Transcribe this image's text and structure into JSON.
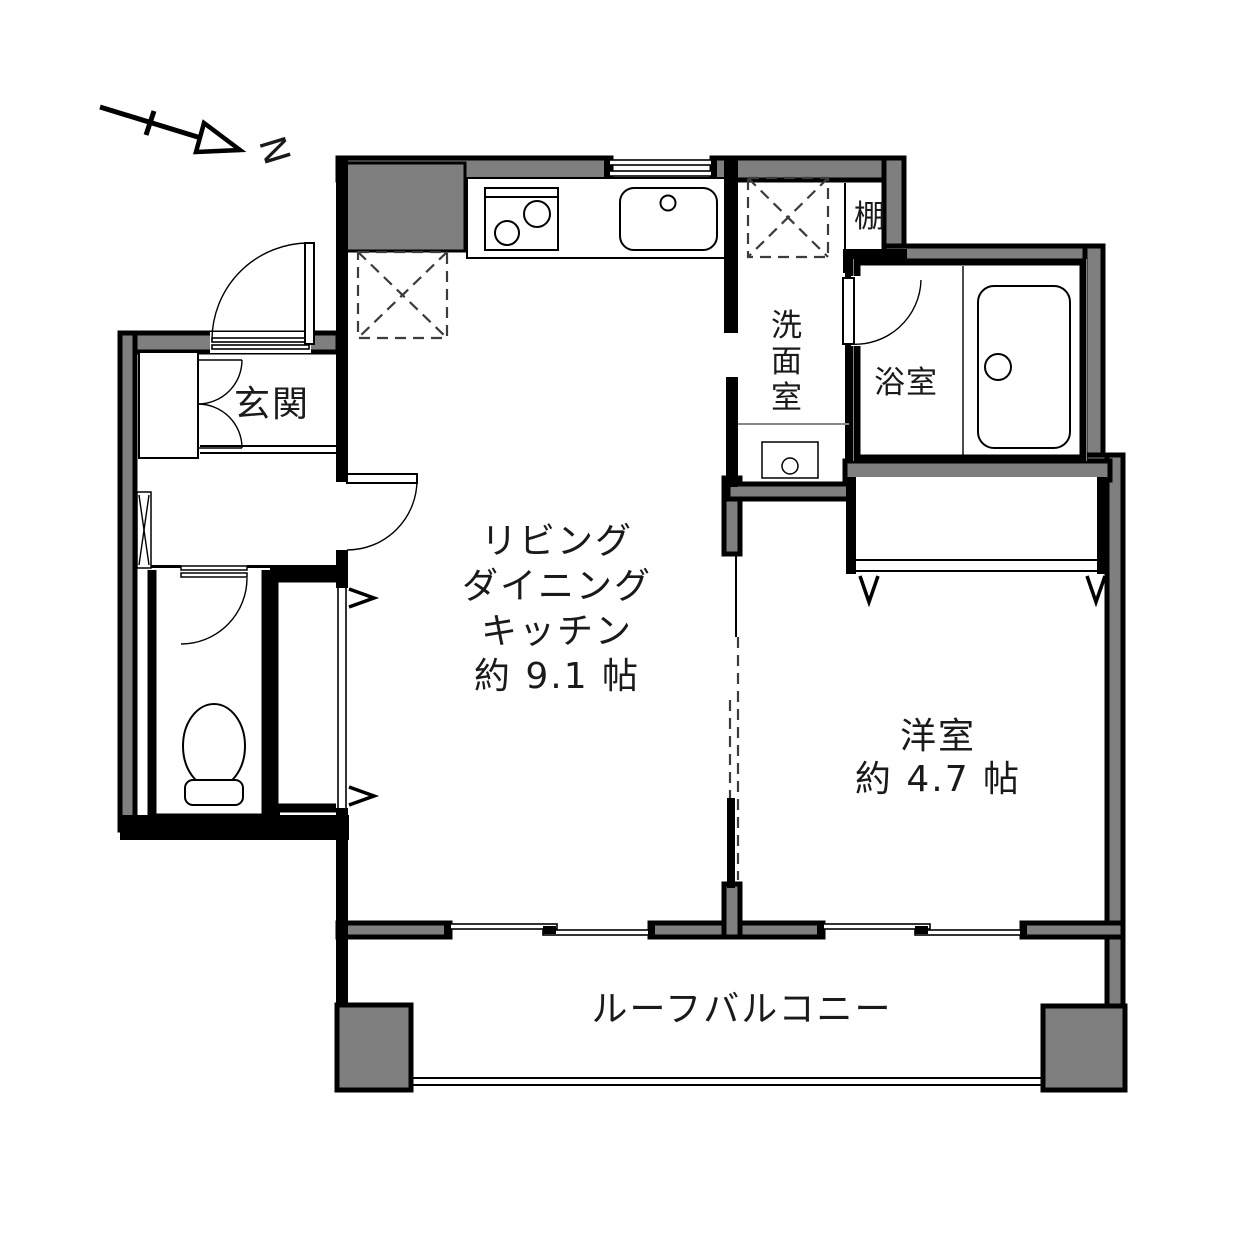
{
  "compass": {
    "label": "N"
  },
  "rooms": {
    "genkan": {
      "label": "玄関"
    },
    "washroom": {
      "chars": [
        "洗",
        "面",
        "室"
      ]
    },
    "bathroom": {
      "label": "浴室"
    },
    "shelf": {
      "label": "棚"
    },
    "ldk": {
      "lines": [
        "リビング",
        "ダイニング",
        "キッチン",
        "約 9.1 帖"
      ]
    },
    "bedroom": {
      "lines": [
        "洋室",
        "約 4.7 帖"
      ]
    },
    "balcony": {
      "label": "ルーフバルコニー"
    }
  },
  "colors": {
    "wall_fill": "#7f7f7f",
    "line": "#000000",
    "background": "#ffffff",
    "text": "#1a1a1a"
  }
}
